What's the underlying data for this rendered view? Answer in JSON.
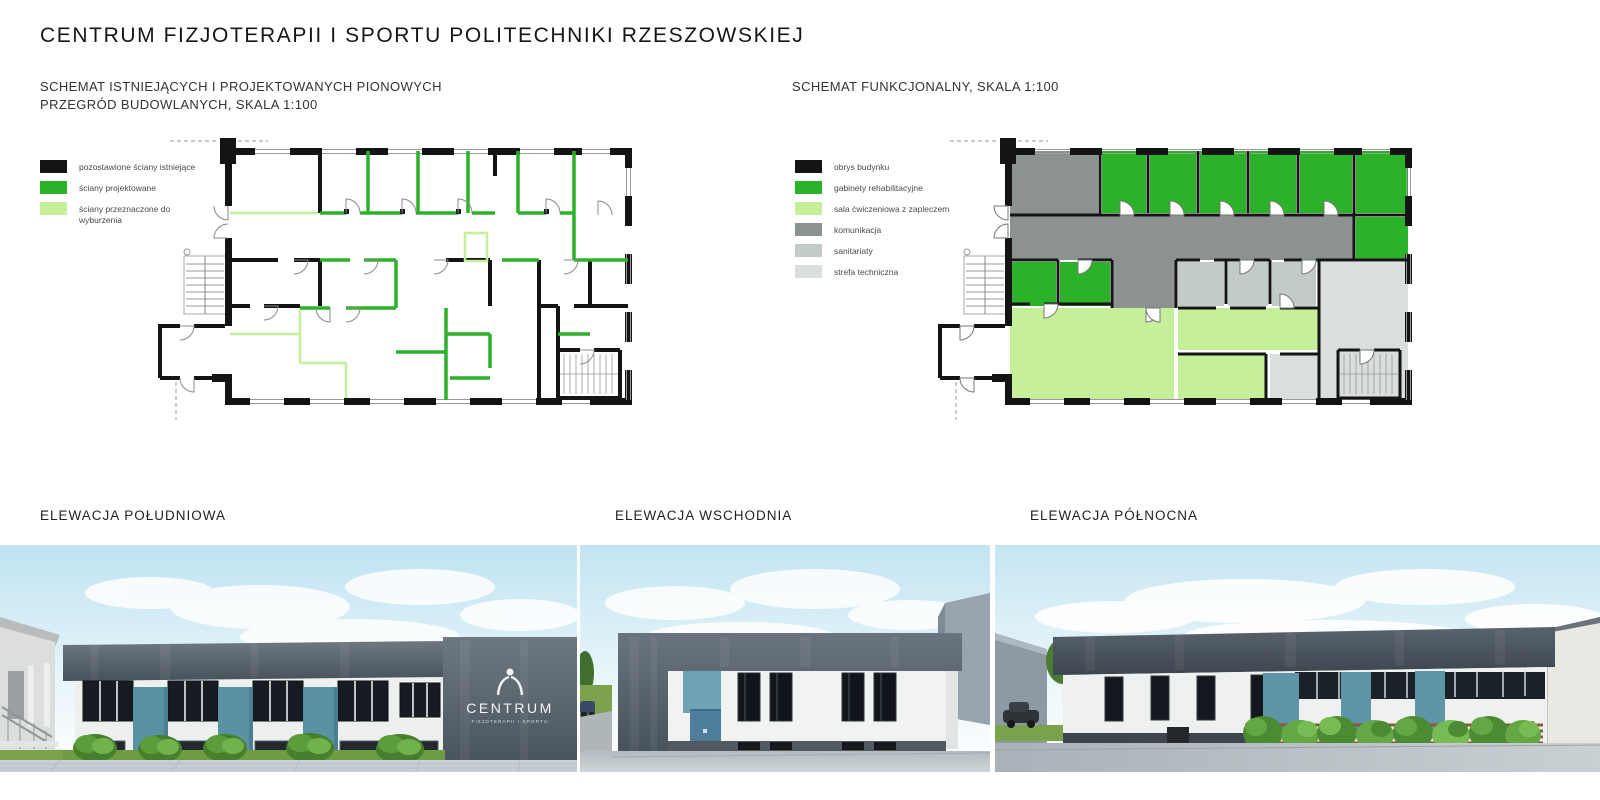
{
  "title": "CENTRUM FIZJOTERAPII I SPORTU POLITECHNIKI RZESZOWSKIEJ",
  "schemes": {
    "walls": {
      "heading_line1": "SCHEMAT ISTNIEJĄCYCH I PROJEKTOWANYCH PIONOWYCH",
      "heading_line2": "PRZEGRÓD BUDOWLANYCH, SKALA 1:100",
      "legend": [
        {
          "label": "pozostawione ściany istniejące",
          "color": "#141414"
        },
        {
          "label": "ściany projektowane",
          "color": "#2BB229"
        },
        {
          "label": "ściany przeznaczone do wyburzenia",
          "color": "#C6EF9C"
        }
      ]
    },
    "functional": {
      "heading": "SCHEMAT FUNKCJONALNY, SKALA 1:100",
      "legend": [
        {
          "label": "obrys budynku",
          "color": "#141414"
        },
        {
          "label": "gabinety rehabilitacyjne",
          "color": "#2BB229"
        },
        {
          "label": "sala ćwiczeniowa z zapleczem",
          "color": "#C6EF9C"
        },
        {
          "label": "komunikacja",
          "color": "#8C9292"
        },
        {
          "label": "sanitariaty",
          "color": "#C2CBC9"
        },
        {
          "label": "strefa techniczna",
          "color": "#DADEDD"
        }
      ]
    }
  },
  "elevations": [
    {
      "label": "ELEWACJA POŁUDNIOWA"
    },
    {
      "label": "ELEWACJA WSCHODNIA"
    },
    {
      "label": "ELEWACJA PÓŁNOCNA"
    }
  ],
  "building_sign": {
    "line1": "CENTRUM",
    "line2": "FIZJOTERAPII I SPORTU"
  }
}
